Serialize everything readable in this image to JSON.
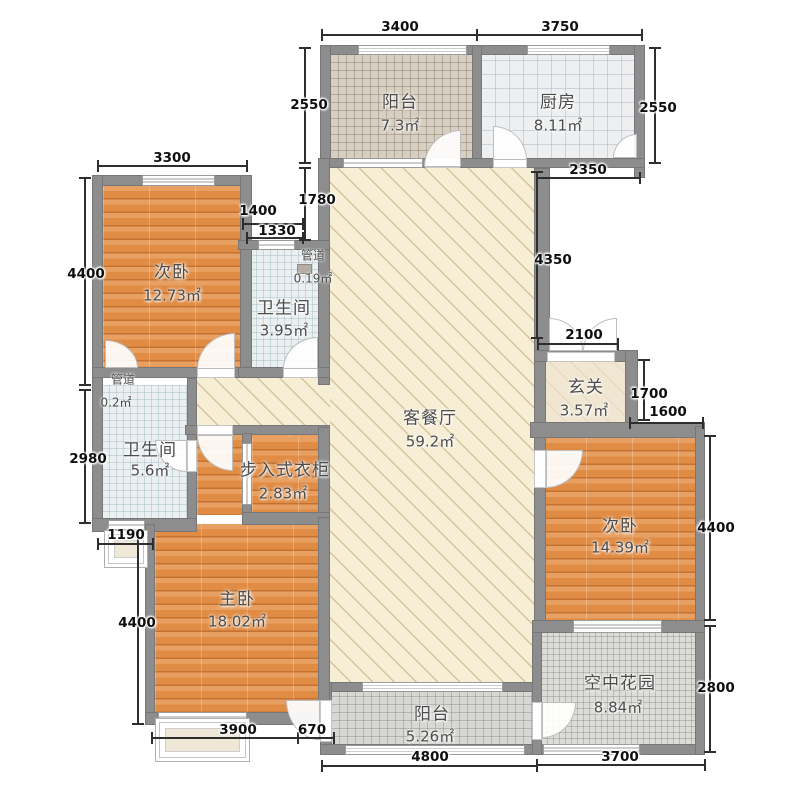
{
  "meta": {
    "type": "apartment-floor-plan",
    "units": "mm",
    "canvas_w": 800,
    "canvas_h": 800
  },
  "palette": {
    "background": "#ffffff",
    "wall": "#8d8d8d",
    "wood_floor": "#e18c44",
    "living_floor": "#f6eed5",
    "bath_floor": "#eaf0f2",
    "kitchen_floor": "#edeff1",
    "balcony_tile": "#d7cfc1",
    "garden_tile": "#dcdcd8",
    "dim_text": "#0f0f0f",
    "label_text": "#4c4c4c"
  },
  "rooms": [
    {
      "id": "balcony-top",
      "name_label": "阳台",
      "area_label": "7.3㎡",
      "floor": "tile-warm",
      "rect": [
        331,
        55,
        141,
        103
      ],
      "name_pos": [
        400,
        100
      ],
      "area_pos": [
        400,
        125
      ]
    },
    {
      "id": "kitchen",
      "name_label": "厨房",
      "area_label": "8.11㎡",
      "floor": "kitchen",
      "rect": [
        482,
        55,
        152,
        103
      ],
      "name_pos": [
        558,
        100
      ],
      "area_pos": [
        558,
        125
      ]
    },
    {
      "id": "bedroom-left",
      "name_label": "次卧",
      "area_label": "12.73㎡",
      "floor": "wood",
      "rect": [
        103,
        186,
        137,
        181
      ],
      "name_pos": [
        172,
        270
      ],
      "area_pos": [
        172,
        295
      ]
    },
    {
      "id": "bath-small",
      "name_label": "卫生间",
      "area_label": "3.95㎡",
      "floor": "bath",
      "rect": [
        250,
        250,
        68,
        117
      ],
      "name_pos": [
        284,
        306
      ],
      "area_pos": [
        284,
        330
      ]
    },
    {
      "id": "living-dining",
      "name_label": "客餐厅",
      "area_label": "59.2㎡",
      "floor": "hatch",
      "rect": [
        330,
        168,
        204,
        514
      ],
      "name_pos": [
        430,
        416
      ],
      "area_pos": [
        430,
        441
      ]
    },
    {
      "id": "corridor",
      "name_label": "",
      "area_label": "",
      "floor": "hatch",
      "rect": [
        197,
        378,
        133,
        47
      ],
      "name_pos": null,
      "area_pos": null
    },
    {
      "id": "hallway",
      "name_label": "玄关",
      "area_label": "3.57㎡",
      "floor": "hallway",
      "rect": [
        546,
        362,
        79,
        60
      ],
      "name_pos": [
        586,
        385
      ],
      "area_pos": [
        584,
        410
      ]
    },
    {
      "id": "bath-big",
      "name_label": "卫生间",
      "area_label": "5.6㎡",
      "floor": "bath",
      "rect": [
        103,
        385,
        84,
        133
      ],
      "name_pos": [
        150,
        448
      ],
      "area_pos": [
        150,
        470
      ]
    },
    {
      "id": "master-upper",
      "name_label": "",
      "area_label": "",
      "floor": "wood",
      "rect": [
        197,
        435,
        121,
        80
      ],
      "name_pos": null,
      "area_pos": null
    },
    {
      "id": "closet",
      "name_label": "步入式衣柜",
      "area_label": "2.83㎡",
      "floor": "wood",
      "rect": [
        252,
        437,
        66,
        75
      ],
      "name_pos": [
        285,
        468
      ],
      "area_pos": [
        283,
        493
      ]
    },
    {
      "id": "master-bedroom",
      "name_label": "主卧",
      "area_label": "18.02㎡",
      "floor": "wood",
      "rect": [
        155,
        524,
        163,
        188
      ],
      "name_pos": [
        237,
        597
      ],
      "area_pos": [
        237,
        621
      ]
    },
    {
      "id": "bedroom-right",
      "name_label": "次卧",
      "area_label": "14.39㎡",
      "floor": "wood",
      "rect": [
        540,
        438,
        155,
        182
      ],
      "name_pos": [
        620,
        524
      ],
      "area_pos": [
        620,
        547
      ]
    },
    {
      "id": "sky-garden",
      "name_label": "空中花园",
      "area_label": "8.84㎡",
      "floor": "garden",
      "rect": [
        542,
        633,
        153,
        111
      ],
      "name_pos": [
        620,
        681
      ],
      "area_pos": [
        618,
        707
      ]
    },
    {
      "id": "balcony-bottom",
      "name_label": "阳台",
      "area_label": "5.26㎡",
      "floor": "tile-gray",
      "rect": [
        332,
        692,
        200,
        52
      ],
      "name_pos": [
        432,
        712
      ],
      "area_pos": [
        430,
        736
      ]
    }
  ],
  "small_labels": [
    {
      "id": "duct-top-name",
      "text": "管道",
      "pos": [
        313,
        255
      ]
    },
    {
      "id": "duct-top-area",
      "text": "0.19㎡",
      "pos": [
        313,
        278
      ]
    },
    {
      "id": "duct-left-name",
      "text": "管道",
      "pos": [
        123,
        379
      ]
    },
    {
      "id": "duct-left-area",
      "text": "0.2㎡",
      "pos": [
        116,
        402
      ]
    }
  ],
  "walls": [
    [
      320,
      45,
      325,
      10
    ],
    [
      320,
      45,
      11,
      123
    ],
    [
      472,
      45,
      10,
      123
    ],
    [
      634,
      45,
      11,
      133
    ],
    [
      320,
      158,
      325,
      10
    ],
    [
      318,
      158,
      12,
      227
    ],
    [
      92,
      175,
      158,
      11
    ],
    [
      92,
      175,
      11,
      355
    ],
    [
      240,
      175,
      12,
      203
    ],
    [
      92,
      367,
      158,
      11
    ],
    [
      238,
      240,
      92,
      10
    ],
    [
      238,
      367,
      92,
      11
    ],
    [
      187,
      378,
      10,
      152
    ],
    [
      92,
      518,
      105,
      14
    ],
    [
      185,
      425,
      145,
      10
    ],
    [
      242,
      433,
      10,
      84
    ],
    [
      318,
      427,
      12,
      90
    ],
    [
      242,
      512,
      88,
      13
    ],
    [
      145,
      524,
      10,
      200
    ],
    [
      145,
      712,
      187,
      13
    ],
    [
      320,
      682,
      222,
      10
    ],
    [
      320,
      682,
      12,
      73
    ],
    [
      320,
      744,
      385,
      11
    ],
    [
      532,
      620,
      10,
      135
    ],
    [
      534,
      168,
      16,
      184
    ],
    [
      534,
      350,
      12,
      283
    ],
    [
      534,
      350,
      103,
      12
    ],
    [
      625,
      350,
      13,
      80
    ],
    [
      530,
      422,
      175,
      16
    ],
    [
      695,
      426,
      10,
      329
    ],
    [
      532,
      620,
      173,
      13
    ],
    [
      318,
      517,
      12,
      200
    ]
  ],
  "openings": [
    {
      "rect": [
        358,
        45,
        109,
        10
      ],
      "style": "win3"
    },
    {
      "rect": [
        527,
        45,
        83,
        10
      ],
      "style": "win3"
    },
    {
      "rect": [
        142,
        175,
        73,
        11
      ],
      "style": "win3"
    },
    {
      "rect": [
        258,
        240,
        37,
        10
      ],
      "style": "win2"
    },
    {
      "rect": [
        343,
        158,
        80,
        10
      ],
      "style": "win2"
    },
    {
      "rect": [
        425,
        158,
        35,
        10
      ],
      "style": "gap"
    },
    {
      "rect": [
        493,
        158,
        34,
        10
      ],
      "style": "gap"
    },
    {
      "rect": [
        197,
        367,
        38,
        11
      ],
      "style": "gap"
    },
    {
      "rect": [
        283,
        367,
        35,
        11
      ],
      "style": "gap"
    },
    {
      "rect": [
        187,
        440,
        10,
        32
      ],
      "style": "gap"
    },
    {
      "rect": [
        197,
        425,
        36,
        10
      ],
      "style": "gap"
    },
    {
      "rect": [
        534,
        450,
        12,
        38
      ],
      "style": "gap"
    },
    {
      "rect": [
        547,
        352,
        68,
        10
      ],
      "style": "gap"
    },
    {
      "rect": [
        362,
        682,
        141,
        10
      ],
      "style": "win3"
    },
    {
      "rect": [
        345,
        745,
        180,
        10
      ],
      "style": "win3"
    },
    {
      "rect": [
        158,
        712,
        89,
        13
      ],
      "style": "win3"
    },
    {
      "rect": [
        108,
        520,
        37,
        10
      ],
      "style": "win2"
    },
    {
      "rect": [
        573,
        620,
        89,
        13
      ],
      "style": "win3"
    },
    {
      "rect": [
        543,
        744,
        97,
        11
      ],
      "style": "win3"
    },
    {
      "rect": [
        320,
        700,
        12,
        42
      ],
      "style": "gap"
    },
    {
      "rect": [
        532,
        702,
        10,
        38
      ],
      "style": "gap"
    },
    {
      "rect": [
        242,
        443,
        10,
        62
      ],
      "style": "win2"
    }
  ],
  "doors": [
    {
      "rect": [
        493,
        126,
        34,
        34
      ],
      "round": "tr"
    },
    {
      "rect": [
        424,
        130,
        37,
        37
      ],
      "round": "tl"
    },
    {
      "rect": [
        197,
        333,
        38,
        36
      ],
      "round": "tl"
    },
    {
      "rect": [
        105,
        340,
        33,
        28
      ],
      "round": "tr"
    },
    {
      "rect": [
        283,
        337,
        35,
        32
      ],
      "round": "tl"
    },
    {
      "rect": [
        155,
        440,
        32,
        32
      ],
      "round": "bl"
    },
    {
      "rect": [
        197,
        435,
        36,
        36
      ],
      "round": "bl"
    },
    {
      "rect": [
        546,
        450,
        37,
        38
      ],
      "round": "br"
    },
    {
      "rect": [
        549,
        318,
        34,
        33
      ],
      "round": "tr"
    },
    {
      "rect": [
        583,
        318,
        34,
        33
      ],
      "round": "tl"
    },
    {
      "rect": [
        286,
        700,
        34,
        40
      ],
      "round": "bl"
    },
    {
      "rect": [
        542,
        702,
        34,
        36
      ],
      "round": "br"
    },
    {
      "rect": [
        613,
        134,
        24,
        24
      ],
      "round": "tl"
    }
  ],
  "bays": [
    [
      104,
      530,
      44,
      38
    ],
    [
      155,
      718,
      95,
      44
    ]
  ],
  "ducts": [
    [
      297,
      264,
      15,
      10
    ]
  ],
  "dims": [
    {
      "label": "3400",
      "label_pos": [
        400,
        27
      ],
      "line": [
        322,
        35,
        477,
        35
      ]
    },
    {
      "label": "3750",
      "label_pos": [
        560,
        27
      ],
      "line": [
        477,
        35,
        642,
        35
      ]
    },
    {
      "label": "2550",
      "label_pos": [
        309,
        105
      ],
      "line": [
        305,
        48,
        305,
        163
      ]
    },
    {
      "label": "2550",
      "label_pos": [
        658,
        108
      ],
      "line": [
        655,
        48,
        655,
        163
      ]
    },
    {
      "label": "2350",
      "label_pos": [
        588,
        170
      ],
      "line": [
        537,
        178,
        640,
        178
      ]
    },
    {
      "label": "3300",
      "label_pos": [
        172,
        158
      ],
      "line": [
        98,
        166,
        247,
        166
      ]
    },
    {
      "label": "1400",
      "label_pos": [
        258,
        211
      ],
      "line": [
        243,
        224,
        303,
        224
      ]
    },
    {
      "label": "1330",
      "label_pos": [
        277,
        231
      ],
      "line": [
        247,
        238,
        303,
        238
      ]
    },
    {
      "label": "1780",
      "label_pos": [
        317,
        200
      ],
      "line": [
        305,
        168,
        305,
        240
      ]
    },
    {
      "label": "4400",
      "label_pos": [
        86,
        274
      ],
      "line": [
        85,
        178,
        85,
        385
      ]
    },
    {
      "label": "2980",
      "label_pos": [
        88,
        459
      ],
      "line": [
        85,
        390,
        85,
        523
      ]
    },
    {
      "label": "4400",
      "label_pos": [
        137,
        623
      ],
      "line": [
        138,
        532,
        138,
        724
      ]
    },
    {
      "label": "1190",
      "label_pos": [
        126,
        535
      ],
      "line": [
        98,
        544,
        153,
        544
      ]
    },
    {
      "label": "3900",
      "label_pos": [
        238,
        730
      ],
      "line": [
        152,
        738,
        298,
        738
      ]
    },
    {
      "label": "670",
      "label_pos": [
        312,
        730
      ],
      "line": [
        298,
        738,
        334,
        738
      ]
    },
    {
      "label": "4800",
      "label_pos": [
        430,
        757
      ],
      "line": [
        322,
        766,
        537,
        766
      ]
    },
    {
      "label": "3700",
      "label_pos": [
        620,
        757
      ],
      "line": [
        537,
        765,
        705,
        765
      ]
    },
    {
      "label": "2800",
      "label_pos": [
        716,
        688
      ],
      "line": [
        710,
        626,
        710,
        752
      ]
    },
    {
      "label": "4400",
      "label_pos": [
        716,
        528
      ],
      "line": [
        710,
        436,
        710,
        620
      ]
    },
    {
      "label": "1600",
      "label_pos": [
        668,
        412
      ],
      "line": [
        630,
        423,
        703,
        423
      ]
    },
    {
      "label": "1700",
      "label_pos": [
        649,
        394
      ],
      "line": [
        644,
        360,
        644,
        420
      ]
    },
    {
      "label": "2100",
      "label_pos": [
        584,
        335
      ],
      "line": [
        538,
        344,
        618,
        344
      ]
    },
    {
      "label": "4350",
      "label_pos": [
        553,
        260
      ],
      "line": [
        537,
        172,
        537,
        338
      ]
    }
  ]
}
